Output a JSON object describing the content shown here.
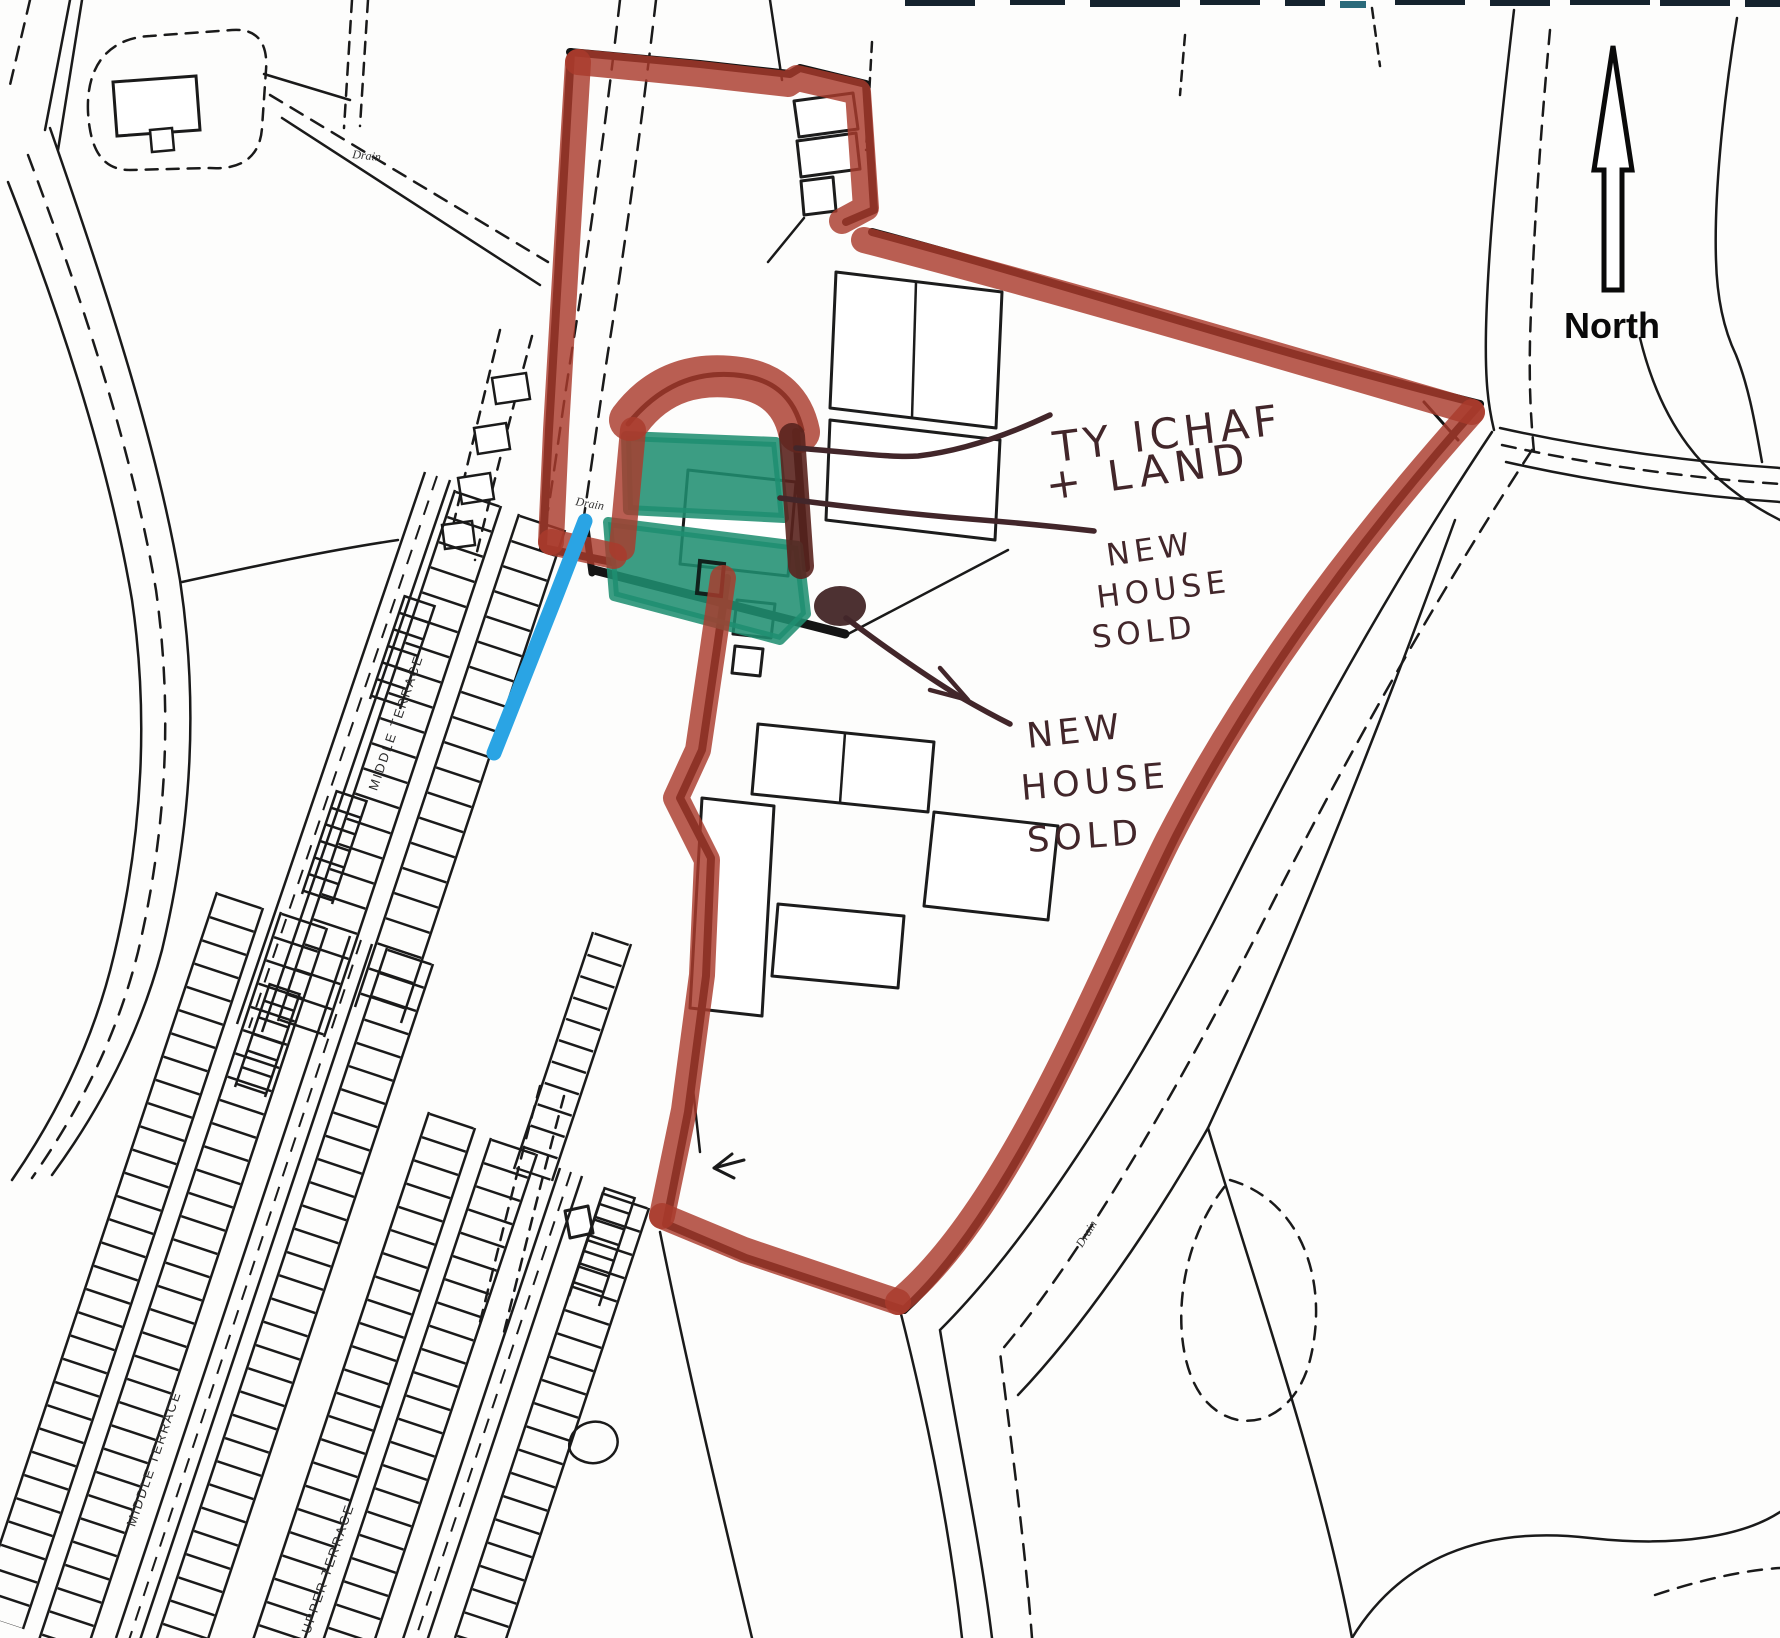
{
  "map": {
    "north_label": "North",
    "annotations": {
      "ty_uchaf": {
        "line1": "TY ICHAF",
        "line2": "+ LAND"
      },
      "new_house_1": {
        "line1": "NEW",
        "line2": "HOUSE",
        "line3": "SOLD"
      },
      "new_house_2": {
        "line1": "NEW",
        "line2": "HOUSE",
        "line3": "SOLD"
      }
    },
    "street_labels": {
      "middle_terrace_upper": "MIDDLE TERRACE",
      "middle_terrace_lower": "MIDDLE TERRACE",
      "upper_terrace": "UPPER TERRACE"
    },
    "feature_labels": {
      "drain_1": "Drain",
      "drain_2": "Drain",
      "drain_3": "Drain"
    },
    "marker_colors": {
      "boundary_red": "#a93b2c",
      "highlight_green": "#1f8e70",
      "highlight_blue": "#2aa4e4",
      "handwriting_ink": "#42262a",
      "map_line": "#1a1a1a"
    }
  }
}
